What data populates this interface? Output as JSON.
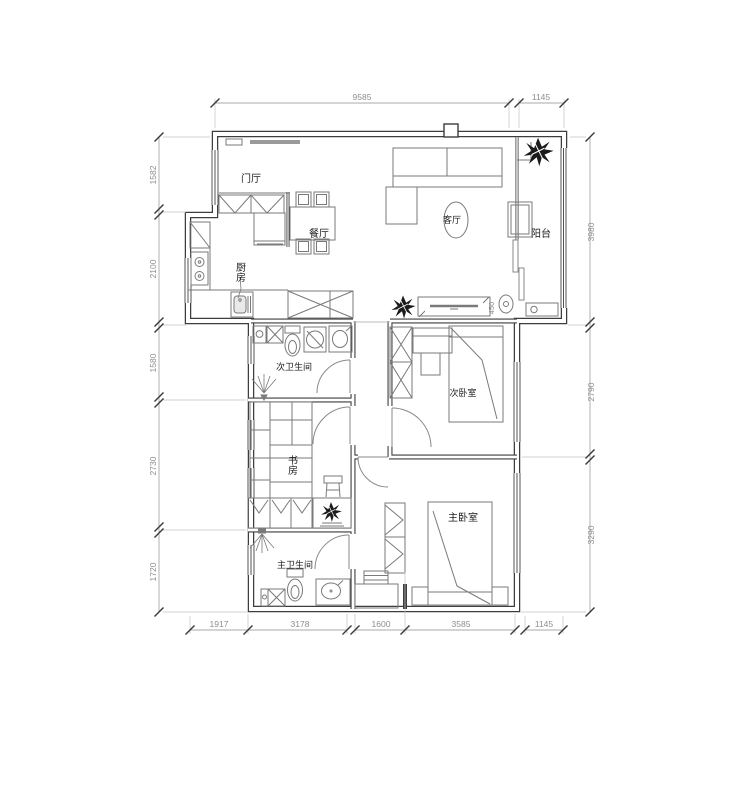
{
  "rooms": {
    "entry": "门厅",
    "dining": "餐厅",
    "kitchen": "厨房",
    "living": "客厅",
    "balcony": "阳台",
    "bath2": "次卫生间",
    "bedroom2": "次卧室",
    "study": "书房",
    "master_bedroom": "主卧室",
    "master_bath": "主卫生间"
  },
  "dims": {
    "top": [
      "9585",
      "1145"
    ],
    "left": [
      "1582",
      "2100",
      "1580",
      "2730",
      "1720"
    ],
    "right": [
      "3980",
      "2790",
      "3290"
    ],
    "bottom": [
      "1917",
      "3178",
      "1600",
      "3585",
      "1145"
    ],
    "tv": "450"
  }
}
